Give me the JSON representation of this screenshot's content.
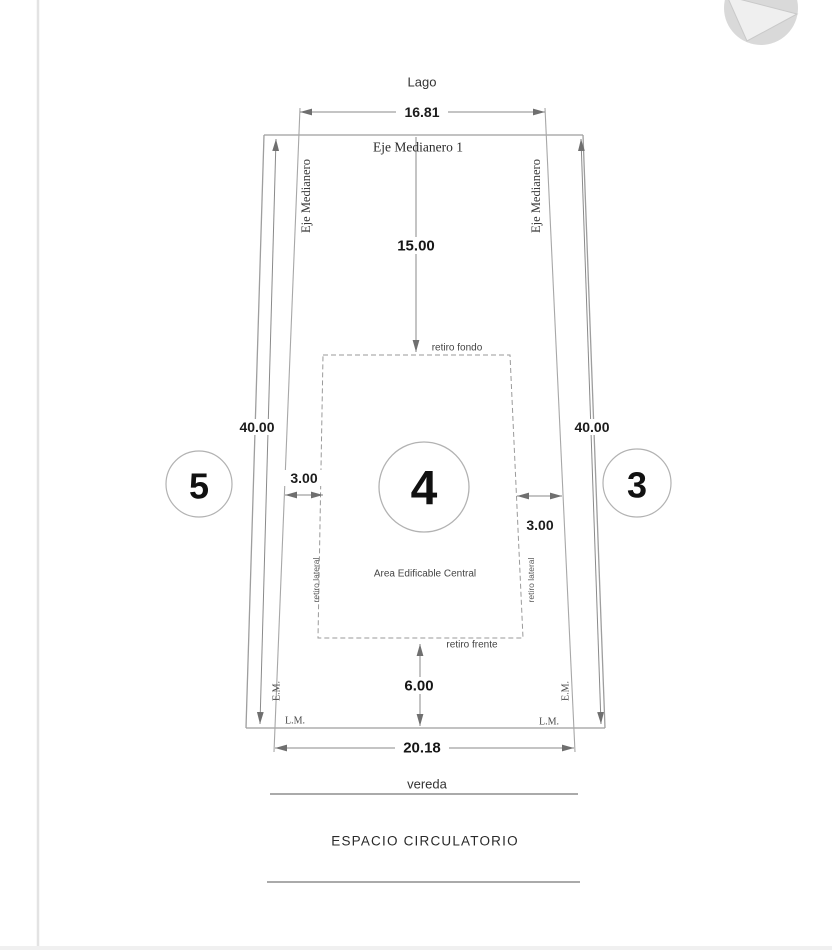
{
  "title": "Plano de lote - esquema de retiros",
  "colors": {
    "line": "#9e9e9e",
    "dim_line": "#8a8a8a",
    "dim_text": "#1a1a1a",
    "label_text": "#444444",
    "logo_gray": "#d9d9d9"
  },
  "surroundings": {
    "top_label": "Lago",
    "walkway_label": "vereda",
    "circulation_label": "ESPACIO CIRCULATORIO"
  },
  "lot": {
    "number": "4",
    "area_label": "Area Edificable Central",
    "neighbor_left": "5",
    "neighbor_right": "3"
  },
  "axes": {
    "top": "Eje Medianero 1",
    "left": "Eje Medianero",
    "right": "Eje Medianero",
    "em_left": "E.M.",
    "em_right": "E.M.",
    "lm_left": "L.M.",
    "lm_right": "L.M."
  },
  "setbacks": {
    "back": "retiro fondo",
    "front": "retiro frente",
    "lateral_left": "retiro lateral",
    "lateral_right": "retiro lateral"
  },
  "dimensions": {
    "top_width": "16.81",
    "bottom_width": "20.18",
    "depth_left": "40.00",
    "depth_right": "40.00",
    "setback_back_depth": "15.00",
    "setback_front_depth": "6.00",
    "setback_side_left": "3.00",
    "setback_side_right": "3.00"
  }
}
